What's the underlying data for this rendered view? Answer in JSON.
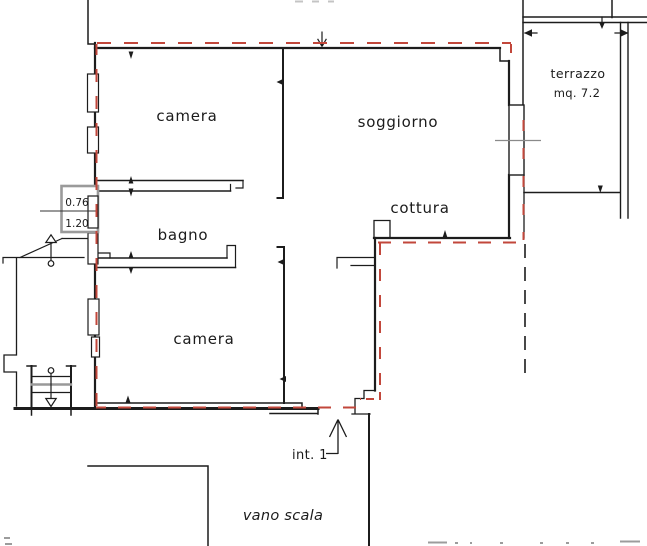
{
  "document": {
    "kind": "apartment floor plan drawing",
    "background": "#ffffff"
  },
  "colors": {
    "wall": "#1c1c1c",
    "boundary": "#c2473b",
    "sill_gray": "#8a8a8a",
    "box_gray": "#9a9a9a",
    "faint": "#9c9c9c"
  },
  "rooms": {
    "camera_top": {
      "label": "camera"
    },
    "soggiorno": {
      "label": "soggiorno"
    },
    "bagno": {
      "label": "bagno"
    },
    "cottura": {
      "label": "cottura"
    },
    "camera_bottom": {
      "label": "camera"
    },
    "terrazzo": {
      "label": "terrazzo",
      "area": "mq. 7.2"
    }
  },
  "annotations": {
    "unit_label": "int. 1",
    "stairwell_label": "vano scala",
    "window_dim_width": "0.76",
    "window_dim_height": "1.20"
  }
}
